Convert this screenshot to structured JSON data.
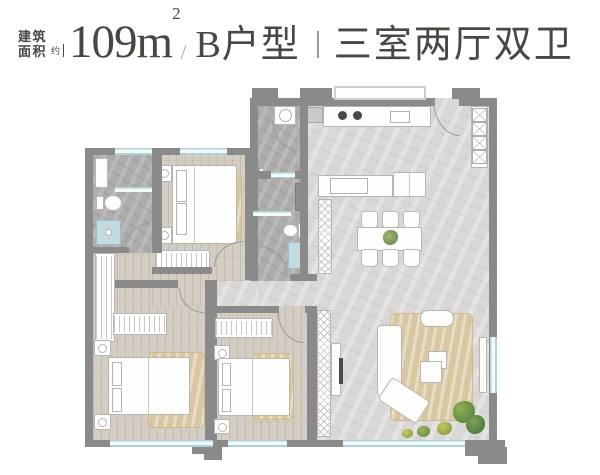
{
  "header": {
    "building_area_label_line1": "建筑",
    "building_area_label_line2": "面积",
    "approx": "约",
    "area_value": "109m",
    "area_superscript": "2",
    "slash": "/",
    "unit_type": "B户型",
    "divider": "|",
    "layout": "三室两厅双卫"
  },
  "colors": {
    "header_text": "#4a4742",
    "slash_accent": "#b3a593",
    "wall": "#8a8a8a",
    "window_glass": "#afd2d8",
    "wood_floor": "#d3cdc3",
    "living_floor": "#d9d8d6",
    "bath_floor": "#aeadab",
    "rug": "#d9c7a2",
    "furniture_outline": "#b5b5b3",
    "shower": "#c2dbe0",
    "plant_green": "#6c9550"
  }
}
